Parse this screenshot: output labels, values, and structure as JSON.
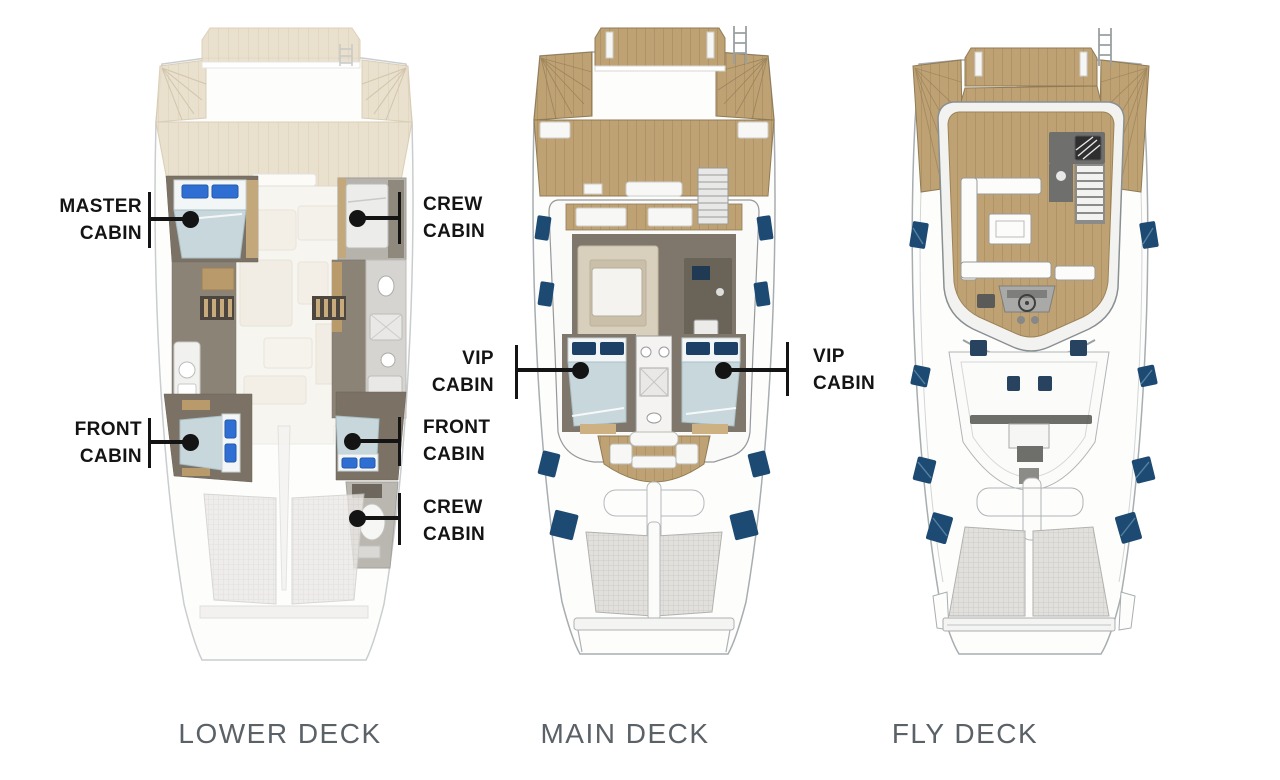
{
  "figure": {
    "type": "catamaran-deck-plans",
    "background": "#ffffff"
  },
  "decks": [
    {
      "id": "lower",
      "title": "LOWER DECK"
    },
    {
      "id": "main",
      "title": "MAIN DECK"
    },
    {
      "id": "fly",
      "title": "FLY DECK"
    }
  ],
  "callouts": [
    {
      "id": "master-cabin",
      "line1": "MASTER",
      "line2": "CABIN",
      "side": "left",
      "text_x": 142,
      "text_y": 220,
      "tick_x": 149,
      "tick_y1": 192,
      "tick_y2": 248,
      "dot_x": 190,
      "dot_y": 219
    },
    {
      "id": "crew-cabin-upper",
      "line1": "CREW",
      "line2": "CABIN",
      "side": "right",
      "text_x": 423,
      "text_y": 218,
      "tick_x": 399,
      "tick_y1": 192,
      "tick_y2": 244,
      "dot_x": 357,
      "dot_y": 218
    },
    {
      "id": "front-cabin-left",
      "line1": "FRONT",
      "line2": "CABIN",
      "side": "left",
      "text_x": 142,
      "text_y": 443,
      "tick_x": 149,
      "tick_y1": 418,
      "tick_y2": 468,
      "dot_x": 190,
      "dot_y": 442
    },
    {
      "id": "front-cabin-right",
      "line1": "FRONT",
      "line2": "CABIN",
      "side": "right",
      "text_x": 423,
      "text_y": 441,
      "tick_x": 399,
      "tick_y1": 417,
      "tick_y2": 466,
      "dot_x": 352,
      "dot_y": 441
    },
    {
      "id": "crew-cabin-lower",
      "line1": "CREW",
      "line2": "CABIN",
      "side": "right",
      "text_x": 423,
      "text_y": 521,
      "tick_x": 399,
      "tick_y1": 493,
      "tick_y2": 545,
      "dot_x": 357,
      "dot_y": 518
    },
    {
      "id": "vip-cabin-left",
      "line1": "VIP",
      "line2": "CABIN",
      "side": "left",
      "text_x": 494,
      "text_y": 372,
      "tick_x": 516,
      "tick_y1": 345,
      "tick_y2": 399,
      "dot_x": 580,
      "dot_y": 370
    },
    {
      "id": "vip-cabin-right",
      "line1": "VIP",
      "line2": "CABIN",
      "side": "right",
      "text_x": 813,
      "text_y": 370,
      "tick_x": 787,
      "tick_y1": 342,
      "tick_y2": 396,
      "dot_x": 723,
      "dot_y": 370
    }
  ],
  "style": {
    "label_color": "#141414",
    "title_color": "#5a6167",
    "pillow_blue": "#2f6fd4",
    "pillow_navy": "#1d4066",
    "window_navy": "#1c4a72",
    "deck_wood": "#bfa274",
    "cabin_floor": "#7b7265",
    "bed_blue": "#c8d7db"
  }
}
